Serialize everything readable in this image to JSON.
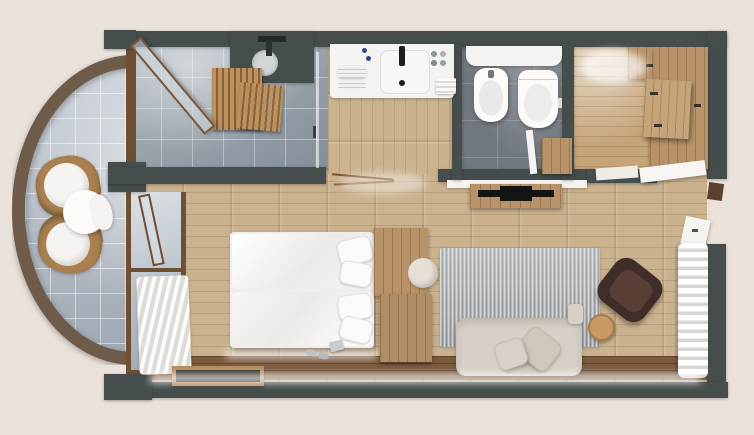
{
  "scene": {
    "type": "architectural-floor-plan-render",
    "view": "top-down-3d",
    "rooms": [
      {
        "name": "balcony",
        "shape": "semicircle",
        "floor": "light-blue-gray-tile",
        "furniture": [
          "wicker-lounge-chair",
          "wicker-lounge-chair",
          "round-side-table-with-throw"
        ]
      },
      {
        "name": "shower-room",
        "floor": "gray-tile",
        "furniture": [
          "walk-in-shower",
          "rain-shower-plate",
          "wood-slat-screen",
          "glass-screen",
          "open-glazed-balcony-door"
        ]
      },
      {
        "name": "vanity-hall",
        "floor": "wood-plank",
        "furniture": [
          "vanity-counter",
          "washbasin",
          "faucet",
          "towel-stack",
          "toiletries",
          "hand-towel"
        ]
      },
      {
        "name": "wc",
        "floor": "dark-gray-tile",
        "furniture": [
          "shelf",
          "bidet",
          "wall-hung-toilet",
          "door"
        ]
      },
      {
        "name": "entry-hall",
        "floor": "wood-plank",
        "furniture": [
          "built-in-wardrobe",
          "wardrobe-shelf-unit",
          "entry-door"
        ]
      },
      {
        "name": "bedroom",
        "floor": "wood-plank",
        "furniture": [
          "double-bed",
          "two-duvets",
          "four-pillows",
          "headboard-divider-unit",
          "pouf",
          "sheer-curtains",
          "luggage-bench",
          "slippers",
          "walking-poles"
        ]
      },
      {
        "name": "living-room",
        "floor": "wood-plank",
        "furniture": [
          "area-rug",
          "sofa-with-cushions",
          "lounge-armchair",
          "round-side-table",
          "tv-sideboard",
          "flat-tv",
          "sheer-curtains",
          "terrace-door"
        ]
      }
    ],
    "palette": {
      "background": "#e9e1da",
      "wall": "#454d4d",
      "wood_floor": "#cbb28f",
      "wood_floor_dark": "#7b5a3e",
      "wood_entry": "#c5a478",
      "wood_furniture": "#b28a5c",
      "tile_light": "#9aa4ae",
      "tile_dark": "#70777d",
      "tile_balcony": "#b5bec8",
      "rattan": "#6f5b49",
      "wicker": "#aa8050",
      "white_soft": "#f4f3f1",
      "glass": "#b9c3cb",
      "window_frame": "#6d4f33",
      "rug": "#b9bcbe",
      "sofa": "#d7d0c7",
      "armchair": "#412d28",
      "tv": "#141414"
    }
  }
}
